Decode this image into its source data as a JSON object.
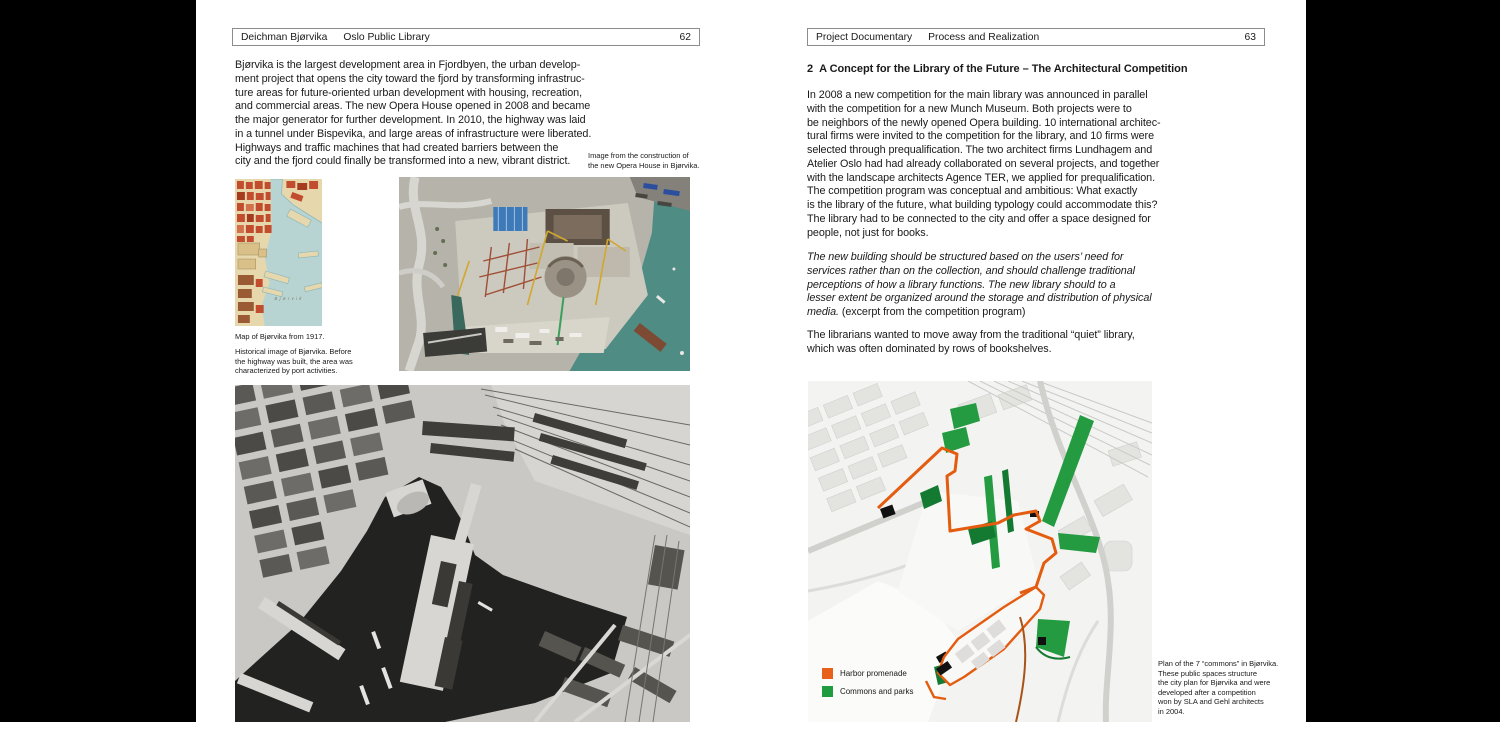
{
  "colors": {
    "promenade_orange": "#E8611B",
    "commons_green": "#1F9C3F",
    "matte_black": "#000000",
    "page_white": "#FFFFFF"
  },
  "left_page": {
    "header": {
      "title_a": "Deichman Bjørvika",
      "title_b": "Oslo Public Library",
      "page_number": "62"
    },
    "body": "Bjørvika is the largest development area in Fjordbyen, the urban develop-\nment project that opens the city toward the fjord by transforming infrastruc-\nture areas for future-oriented urban development with housing, recreation,\nand commercial areas. The new Opera House opened in 2008 and became\nthe major generator for further development. In 2010, the highway was laid\nin a tunnel under Bispevika, and large areas of infrastructure were liberated.\nHighways and traffic machines that had created barriers between the\ncity and the fjord could finally be transformed into a new, vibrant district.",
    "photo_caption": "Image from the construction of\nthe new Opera House in Bjørvika.",
    "map_caption_1": "Map of Bjørvika from 1917.",
    "map_caption_2": "Historical image of Bjørvika. Before\nthe highway was built, the area was\ncharacterized by port activities.",
    "map_water_label": "Bjørvik"
  },
  "right_page": {
    "header": {
      "title_a": "Project Documentary",
      "title_b": "Process and Realization",
      "page_number": "63"
    },
    "heading": "2  A Concept for the Library of the Future – The Architectural Competition",
    "para_1": "In 2008 a new competition for the main library was announced in parallel\nwith the competition for a new Munch Museum. Both projects were to\nbe neighbors of the newly opened Opera building. 10 international architec-\ntural firms were invited to the competition for the library, and 10 firms were\nselected through prequalification. The two architect firms Lundhagem and\nAtelier Oslo had had already collaborated on several projects, and together\nwith the landscape architects Agence TER, we applied for prequalification.\nThe competition program was conceptual and ambitious: What exactly\nis the library of the future, what building typology could accommodate this?\nThe library had to be connected to the city and offer a space designed for\npeople, not just for books.",
    "quote_italic": "The new building should be structured based on the users’ need for\nservices rather than on the collection, and should challenge traditional\nperceptions of how a library functions. The new library should to a\nlesser extent be organized around the storage and distribution of physical\nmedia.",
    "quote_source": " (excerpt from the competition program)",
    "para_3": "The librarians wanted to move away from the traditional “quiet” library,\nwhich was often dominated by rows of bookshelves.",
    "plan": {
      "legend": [
        {
          "label": "Harbor promenade",
          "color": "#E8611B"
        },
        {
          "label": "Commons and parks",
          "color": "#1F9C3F"
        }
      ],
      "caption": "Plan of the 7 “commons” in Bjørvika.\nThese public spaces structure\nthe city plan for Bjørvika and were\ndeveloped after a competition\nwon by SLA and Gehl architects\nin 2004."
    }
  }
}
